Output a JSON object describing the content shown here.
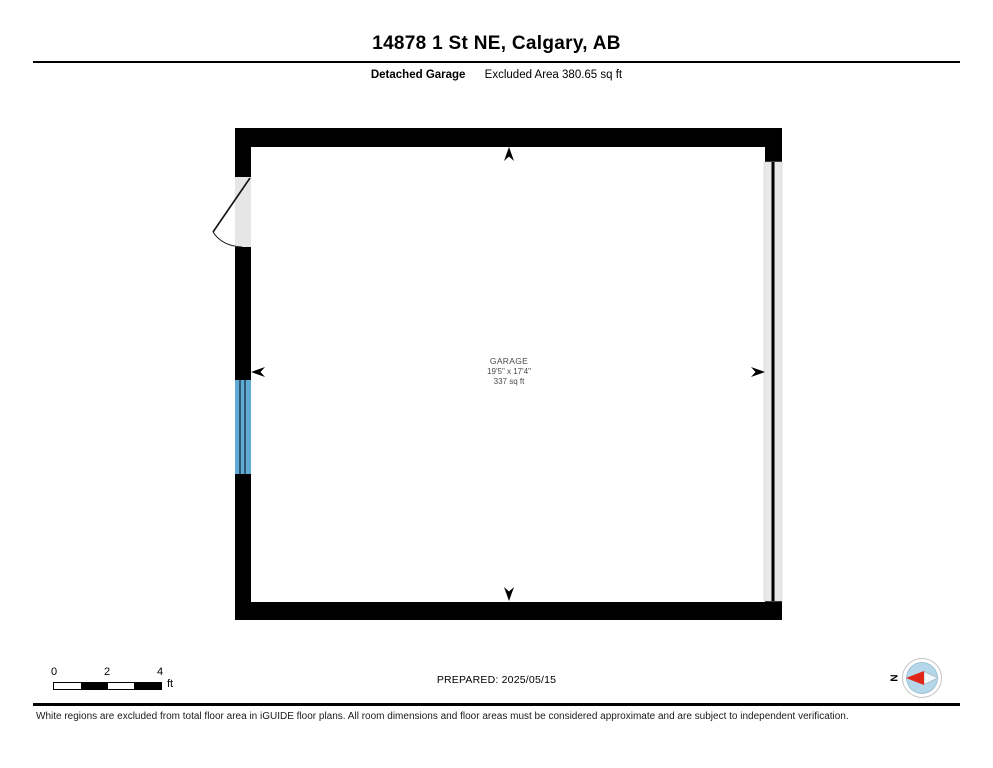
{
  "header": {
    "title": "14878 1 St NE, Calgary, AB",
    "floor_label": "Detached Garage",
    "area_label": "Excluded Area 380.65 sq ft"
  },
  "floorplan": {
    "room": {
      "name": "GARAGE",
      "dimensions": "19'5\" x 17'4\"",
      "area": "337 sq ft"
    },
    "colors": {
      "wall": "#000000",
      "window": "#5fabd6",
      "door_opening": "#e6e6e6",
      "garage_door": "#e9e9e9",
      "label_text": "#4a4a4a"
    }
  },
  "footer": {
    "scale": {
      "ticks": [
        "0",
        "2",
        "4"
      ],
      "unit": "ft"
    },
    "prepared": "PREPARED: 2025/05/15",
    "compass": {
      "label": "N",
      "needle_color": "#e02519",
      "disc_color": "#b4d7e9"
    },
    "disclaimer": "White regions are excluded from total floor area in iGUIDE floor plans. All room dimensions and floor areas must be considered approximate and are subject to independent verification."
  }
}
